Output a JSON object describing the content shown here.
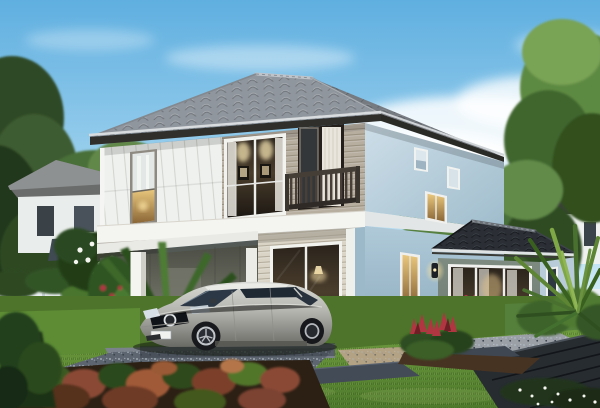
{
  "scene": {
    "description": "Daytime exterior rendering of a modern two-story detached house with gray hip roof, second-floor balcony, warm-lit windows, open carport with parked silver hatchback, single-story glass sun-room extension, tropical landscaped garden, white perimeter fence and neighbouring houses among trees",
    "view": "front-left three-quarter exterior view",
    "objects": [
      "sky",
      "clouds",
      "background-trees",
      "neighbor-house-left",
      "neighbor-house-right",
      "white-fence",
      "hedge",
      "main-house",
      "hip-roof",
      "tall-window",
      "lit-picture-window",
      "balcony",
      "balcony-door",
      "floor-band",
      "carport",
      "carport-columns",
      "silver-hatchback-car",
      "siding-wall",
      "sliding-glass-door",
      "side-wall-windows",
      "sun-room-extension",
      "extension-glass-doors",
      "wall-lamp",
      "gravel-driveway",
      "paved-pad",
      "stone-pavers",
      "timber-deck",
      "pebble-bed",
      "lawn",
      "palm-plants",
      "plumeria-flowers",
      "red-bromeliad-flowers",
      "spiky-agave-plant",
      "foreground-shrub-bed"
    ]
  },
  "palette": {
    "sky_top": "#5FAFE0",
    "sky_mid": "#A9D7F0",
    "sky_horizon": "#DDF0F8",
    "cloud": "#FFFFFF",
    "roof_tile": "#9AA0A7",
    "roof_fascia": "#312F2B",
    "gutter": "#D9DCDE",
    "wall_panel_white": "#EFF1EE",
    "wall_tan": "#B7AEA0",
    "wall_siding_cream": "#D9D4C6",
    "wall_blue_light": "#CDDEE8",
    "wall_blue_deep": "#9FBCCC",
    "floor_band_white": "#F4F4F1",
    "balcony_rail": "#453E37",
    "window_frame_white": "#F2F2EF",
    "window_warm_glow": "#E9C87E",
    "window_interior_dark": "#2B241C",
    "extension_wall_green": "#7E8B80",
    "extension_roof": "#2B2F35",
    "lamp_glow": "#F6DFA2",
    "car_silver_light": "#D9D9D5",
    "car_silver_dark": "#6A6A65",
    "car_glass": "#2C3845",
    "lawn_green": "#4E7A2C",
    "lawn_bright": "#6F9C3F",
    "gravel_blue_gray": "#5D6570",
    "gravel_tan": "#B3A284",
    "paver_slate": "#3E4651",
    "deck_dark": "#272C31",
    "shrub_red": "#8A4A34",
    "shrub_green_dark": "#2F4A1E",
    "tree_green_dark": "#3C5C30",
    "tree_green_mid": "#558040",
    "tree_green_bright": "#79A355",
    "fence_white": "#EAEFF1",
    "flower_red": "#B03642",
    "flower_white": "#F6F6F0"
  }
}
